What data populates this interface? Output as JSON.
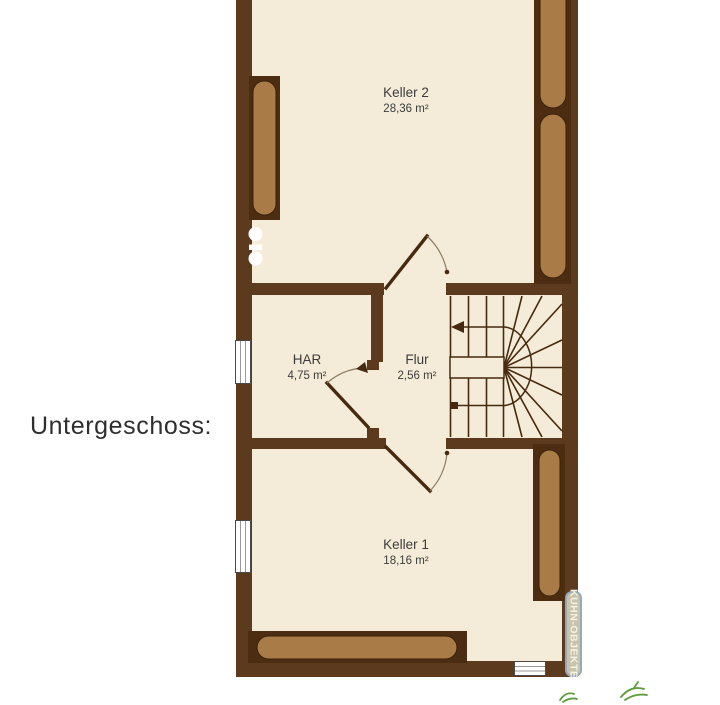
{
  "title": "Untergeschoss:",
  "plan": {
    "rooms": [
      {
        "name": "Keller 2",
        "area": "28,36 m²"
      },
      {
        "name": "HAR",
        "area": "4,75 m²"
      },
      {
        "name": "Flur",
        "area": "2,56 m²"
      },
      {
        "name": "Keller 1",
        "area": "18,16 m²"
      }
    ],
    "watermark": "KUHN-OBJEKTE",
    "colors": {
      "wall": "#5b3a1d",
      "fixture_frame": "#4c2d12",
      "fixture_fill": "#a97c47",
      "floor": "#f4ecd8",
      "line": "#46290f",
      "label_text": "#3c3c3c",
      "watermark_bg": "#c9c3ab",
      "watermark_border": "#95a9bc",
      "watermark_text": "#f7f3e2",
      "accent_green": "#5f9c3d",
      "title_text": "#2e2e2e",
      "page_bg": "#ffffff"
    }
  }
}
